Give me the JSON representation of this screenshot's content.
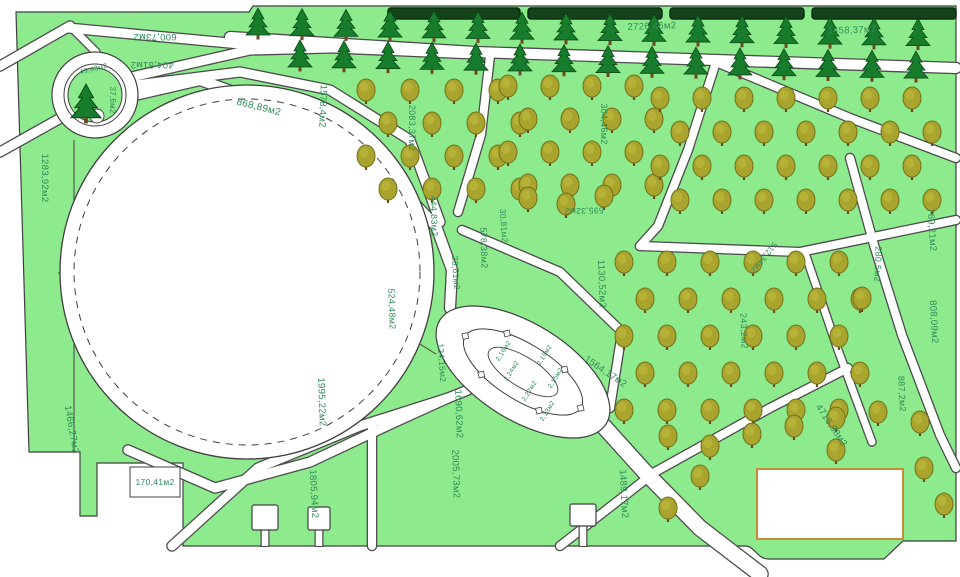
{
  "plan": {
    "unit": "м2",
    "colors": {
      "lawn": "#8deb8d",
      "road_fill": "#ffffff",
      "road_casing": "#4c4c4c",
      "outline": "#3f3f3f",
      "label": "#2e8b57",
      "hedge": "#14421a",
      "hedge_edge": "#0a2e10",
      "conifer": "#177d2c",
      "conifer_edge": "#0a4a16",
      "deciduous": "#a9a42e",
      "deciduous_edge": "#71711a",
      "trunk": "#6b4a22",
      "pad_border": "#c8883c"
    },
    "labels": [
      {
        "text": "600,73м2",
        "x": 155,
        "y": 34,
        "rot": 180,
        "size": 9.5
      },
      {
        "text": "404,81м2",
        "x": 152,
        "y": 62,
        "rot": 180,
        "size": 9.5
      },
      {
        "text": "49,43м2",
        "x": 94,
        "y": 71,
        "rot": -14,
        "size": 7
      },
      {
        "text": "37,6м2",
        "x": 110,
        "y": 100,
        "rot": 90,
        "size": 8
      },
      {
        "text": "1283,92м2",
        "x": 42,
        "y": 178,
        "rot": 90,
        "size": 9.5
      },
      {
        "text": "868,89м2",
        "x": 258,
        "y": 110,
        "rot": 14,
        "size": 10
      },
      {
        "text": "1578,4м2",
        "x": 320,
        "y": 106,
        "rot": 92,
        "size": 9.5
      },
      {
        "text": "2083,37м2",
        "x": 409,
        "y": 128,
        "rot": 90,
        "size": 9
      },
      {
        "text": "304,46м2",
        "x": 601,
        "y": 124,
        "rot": 90,
        "size": 9
      },
      {
        "text": "2726,46м2",
        "x": 652,
        "y": 29,
        "rot": -2,
        "size": 9.5
      },
      {
        "text": "1458,37м2",
        "x": 852,
        "y": 33,
        "rot": -2,
        "size": 9.5
      },
      {
        "text": "444,83м2",
        "x": 431,
        "y": 216,
        "rot": 88,
        "size": 9
      },
      {
        "text": "578,38м2",
        "x": 481,
        "y": 248,
        "rot": 88,
        "size": 9
      },
      {
        "text": "30,81м2",
        "x": 501,
        "y": 226,
        "rot": 86,
        "size": 8.5
      },
      {
        "text": "28,61м2",
        "x": 453,
        "y": 273,
        "rot": 86,
        "size": 8.5
      },
      {
        "text": "524,48м2",
        "x": 389,
        "y": 309,
        "rot": 88,
        "size": 9
      },
      {
        "text": "595,32м2",
        "x": 584,
        "y": 208,
        "rot": 178,
        "size": 8.5
      },
      {
        "text": "1130,52м2",
        "x": 599,
        "y": 284,
        "rot": 88,
        "size": 9.5
      },
      {
        "text": "769,21м2",
        "x": 929,
        "y": 230,
        "rot": 86,
        "size": 9.5
      },
      {
        "text": "280,5м2",
        "x": 875,
        "y": 264,
        "rot": 92,
        "size": 9
      },
      {
        "text": "808,09м2",
        "x": 931,
        "y": 322,
        "rot": 87,
        "size": 9.5
      },
      {
        "text": "243,2м2",
        "x": 741,
        "y": 331,
        "rot": 88,
        "size": 9
      },
      {
        "text": "512,34м2",
        "x": 762,
        "y": 256,
        "rot": 128,
        "size": 8
      },
      {
        "text": "124,15м2",
        "x": 439,
        "y": 363,
        "rot": 86,
        "size": 8.5
      },
      {
        "text": "1690,62м2",
        "x": 456,
        "y": 414,
        "rot": 88,
        "size": 9.5
      },
      {
        "text": "1564,17м2",
        "x": 604,
        "y": 374,
        "rot": 34,
        "size": 9.5
      },
      {
        "text": "1995,22м2",
        "x": 319,
        "y": 402,
        "rot": 88,
        "size": 9.5
      },
      {
        "text": "1466,27м2",
        "x": 69,
        "y": 430,
        "rot": 80,
        "size": 9.5
      },
      {
        "text": "170,41м2",
        "x": 155,
        "y": 485,
        "rot": 0,
        "size": 8.5
      },
      {
        "text": "1805,94м2",
        "x": 311,
        "y": 494,
        "rot": 87,
        "size": 9.5
      },
      {
        "text": "2005,73м2",
        "x": 453,
        "y": 474,
        "rot": 88,
        "size": 9.5
      },
      {
        "text": "1489,17м2",
        "x": 621,
        "y": 494,
        "rot": 87,
        "size": 9.5
      },
      {
        "text": "4716,88м2",
        "x": 829,
        "y": 427,
        "rot": 56,
        "size": 9.5
      },
      {
        "text": "887,2м2",
        "x": 899,
        "y": 394,
        "rot": 87,
        "size": 9
      },
      {
        "text": "2,16м2",
        "x": 505,
        "y": 352,
        "rot": -58,
        "size": 6.5
      },
      {
        "text": "2,24м2",
        "x": 513,
        "y": 372,
        "rot": -58,
        "size": 6.5
      },
      {
        "text": "2,27м2",
        "x": 531,
        "y": 392,
        "rot": -58,
        "size": 6.5
      },
      {
        "text": "2,19м2",
        "x": 546,
        "y": 356,
        "rot": -58,
        "size": 6.5
      },
      {
        "text": "2,15м2",
        "x": 557,
        "y": 379,
        "rot": -58,
        "size": 6.5
      },
      {
        "text": "2,13м2",
        "x": 549,
        "y": 412,
        "rot": -58,
        "size": 6.5
      }
    ],
    "geometry": {
      "outline": "M 16,12 L 249,12 L 253,6 L 956,6 L 956,541 L 903,541 L 884,559 L 768,559 C 757,559 755,546 745,546 L 183,546 L 183,463 L 97,463 L 97,516 L 80,516 L 80,452 L 29,452 Z",
      "parcel_lines": [
        [
          [
            74,
            140
          ],
          [
            74,
            452
          ]
        ],
        [
          [
            58,
            273
          ],
          [
            96,
            273
          ]
        ],
        [
          [
            436,
            354
          ],
          [
            410,
            338
          ]
        ]
      ],
      "roads": [
        {
          "pts": [
            [
              70,
              26
            ],
            [
              0,
              66
            ]
          ],
          "w": 9
        },
        {
          "pts": [
            [
              70,
              26
            ],
            [
              96,
              52
            ]
          ],
          "w": 7
        },
        {
          "pts": [
            [
              68,
              28
            ],
            [
              240,
              44
            ],
            [
              475,
              54
            ]
          ],
          "w": 9
        },
        {
          "pts": [
            [
              118,
              80
            ],
            [
              250,
              50
            ],
            [
              330,
              48
            ]
          ],
          "w": 9
        },
        {
          "pts": [
            [
              230,
              37
            ],
            [
              475,
              52
            ],
            [
              716,
              60
            ],
            [
              956,
              68
            ]
          ],
          "w": 10
        },
        {
          "pts": [
            [
              490,
              56
            ],
            [
              481,
              135
            ],
            [
              458,
              212
            ]
          ],
          "w": 8
        },
        {
          "pts": [
            [
              716,
              62
            ],
            [
              850,
              118
            ],
            [
              956,
              158
            ]
          ],
          "w": 8
        },
        {
          "pts": [
            [
              128,
              86
            ],
            [
              240,
              72
            ],
            [
              330,
              90
            ],
            [
              410,
              140
            ],
            [
              440,
              222
            ]
          ],
          "w": 9
        },
        {
          "pts": [
            [
              122,
              98
            ],
            [
              200,
              80
            ],
            [
              290,
              112
            ],
            [
              380,
              168
            ],
            [
              436,
              226
            ],
            [
              452,
              270
            ],
            [
              450,
              308
            ]
          ],
          "w": 10
        },
        {
          "pts": [
            [
              66,
              115
            ],
            [
              0,
              152
            ]
          ],
          "w": 9
        },
        {
          "pts": [
            [
              598,
              420
            ],
            [
              645,
              472
            ],
            [
              700,
              528
            ],
            [
              760,
              574
            ]
          ],
          "w": 15
        },
        {
          "pts": [
            [
              172,
              546
            ],
            [
              258,
              468
            ],
            [
              360,
              426
            ],
            [
              448,
              398
            ],
            [
              468,
              390
            ]
          ],
          "w": 9
        },
        {
          "pts": [
            [
              128,
              450
            ],
            [
              215,
              488
            ],
            [
              310,
              462
            ],
            [
              395,
              422
            ],
            [
              448,
              398
            ]
          ],
          "w": 9
        },
        {
          "pts": [
            [
              372,
              424
            ],
            [
              372,
              546
            ]
          ],
          "w": 8
        },
        {
          "pts": [
            [
              640,
              246
            ],
            [
              800,
              252
            ],
            [
              956,
              220
            ]
          ],
          "w": 8
        },
        {
          "pts": [
            [
              716,
              62
            ],
            [
              688,
              150
            ],
            [
              658,
              226
            ],
            [
              640,
              246
            ]
          ],
          "w": 8
        },
        {
          "pts": [
            [
              850,
              158
            ],
            [
              874,
              245
            ],
            [
              902,
              335
            ],
            [
              940,
              435
            ],
            [
              956,
              468
            ]
          ],
          "w": 8
        },
        {
          "pts": [
            [
              805,
              253
            ],
            [
              838,
              350
            ],
            [
              872,
              442
            ]
          ],
          "w": 7
        },
        {
          "pts": [
            [
              462,
              230
            ],
            [
              560,
              272
            ],
            [
              622,
              332
            ],
            [
              610,
              408
            ]
          ],
          "w": 8
        },
        {
          "pts": [
            [
              560,
              546
            ],
            [
              655,
              472
            ],
            [
              770,
              408
            ],
            [
              848,
              368
            ]
          ],
          "w": 8
        }
      ],
      "big_circle": {
        "cx": 247,
        "cy": 272,
        "r": 187,
        "r_dashed": 173
      },
      "roundabout": {
        "cx": 95,
        "cy": 95,
        "r_outer": 43,
        "r_mid": 31,
        "r_inner": 27,
        "bush": {
          "cx": 97,
          "cy": 116,
          "r": 7
        }
      },
      "oval_bed": {
        "cx": 523,
        "cy": 372,
        "angle": 32,
        "rx1": 98,
        "ry1": 48,
        "rx2": 68,
        "ry2": 28,
        "rx3": 40,
        "ry3": 15,
        "node_angles": [
          0,
          60,
          120,
          180,
          240,
          300
        ],
        "node_size": 4
      },
      "hedge": {
        "y": 8,
        "h": 11,
        "segments": [
          [
            388,
            520
          ],
          [
            528,
            662
          ],
          [
            670,
            804
          ],
          [
            812,
            956
          ]
        ]
      },
      "label_box": {
        "x": 130,
        "y": 467,
        "w": 50,
        "h": 30
      },
      "pad_rect": {
        "x": 757,
        "y": 469,
        "w": 146,
        "h": 70
      },
      "gates": [
        {
          "x": 252,
          "y": 505,
          "w": 26,
          "h": 25
        },
        {
          "x": 308,
          "y": 507,
          "w": 22,
          "h": 23
        },
        {
          "x": 570,
          "y": 504,
          "w": 26,
          "h": 22
        }
      ],
      "trees": {
        "conifer_rows": [
          {
            "x0": 258,
            "n": 16,
            "dx": 44,
            "y0": 24,
            "slope": 0.016
          },
          {
            "x0": 300,
            "n": 15,
            "dx": 44,
            "y0": 56,
            "slope": 0.018
          }
        ],
        "conifer_single": [
          [
            86,
            104,
            1.25
          ]
        ],
        "deciduous_grids": [
          {
            "x0": 366,
            "y0": 92,
            "cols": 4,
            "rows": 4,
            "dx": 44,
            "dy": 33,
            "stag": 22
          },
          {
            "x0": 508,
            "y0": 88,
            "cols": 4,
            "rows": 4,
            "dx": 42,
            "dy": 33,
            "stag": 20
          },
          {
            "x0": 660,
            "y0": 100,
            "cols": 7,
            "rows": 4,
            "dx": 42,
            "dy": 34,
            "stag": 20
          },
          {
            "x0": 624,
            "y0": 264,
            "cols": 6,
            "rows": 5,
            "dx": 43,
            "dy": 37,
            "stag": 21
          }
        ],
        "deciduous_extra": [
          [
            528,
            200
          ],
          [
            566,
            206
          ],
          [
            604,
            198
          ],
          [
            862,
            300
          ],
          [
            668,
            438
          ],
          [
            710,
            448
          ],
          [
            752,
            436
          ],
          [
            794,
            428
          ],
          [
            836,
            420
          ],
          [
            878,
            414
          ],
          [
            920,
            424
          ],
          [
            700,
            478
          ],
          [
            668,
            510
          ],
          [
            924,
            470
          ],
          [
            944,
            506
          ],
          [
            836,
            452
          ]
        ]
      }
    }
  }
}
